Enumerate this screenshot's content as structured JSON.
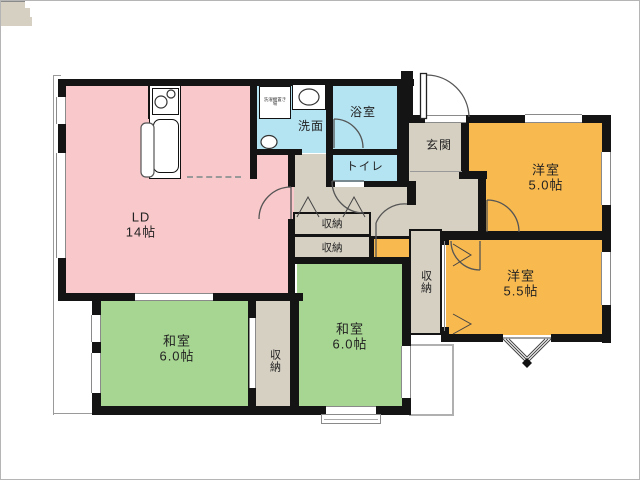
{
  "rooms": {
    "ld": {
      "label": "LD",
      "size": "14帖"
    },
    "washroom": {
      "label": "洗面"
    },
    "bathroom": {
      "label": "浴室"
    },
    "toilet": {
      "label": "トイレ"
    },
    "entrance": {
      "label": "玄関"
    },
    "western_5_0": {
      "label": "洋室",
      "size": "5.0帖"
    },
    "western_5_5": {
      "label": "洋室",
      "size": "5.5帖"
    },
    "japanese_left": {
      "label": "和室",
      "size": "6.0帖"
    },
    "japanese_center": {
      "label": "和室",
      "size": "6.0帖"
    },
    "closet_hall_1": {
      "label": "収納"
    },
    "closet_hall_2": {
      "label": "収納"
    },
    "closet_left": {
      "label": "収納"
    },
    "closet_right": {
      "label": "収納"
    },
    "laundry": {
      "label": "洗濯機置き場"
    }
  },
  "colors": {
    "living": "#f9c8cb",
    "japanese": "#a7d692",
    "western": "#f8b94f",
    "wet": "#b4e4f2",
    "hall": "#d6d0c3",
    "wall": "#141414"
  }
}
